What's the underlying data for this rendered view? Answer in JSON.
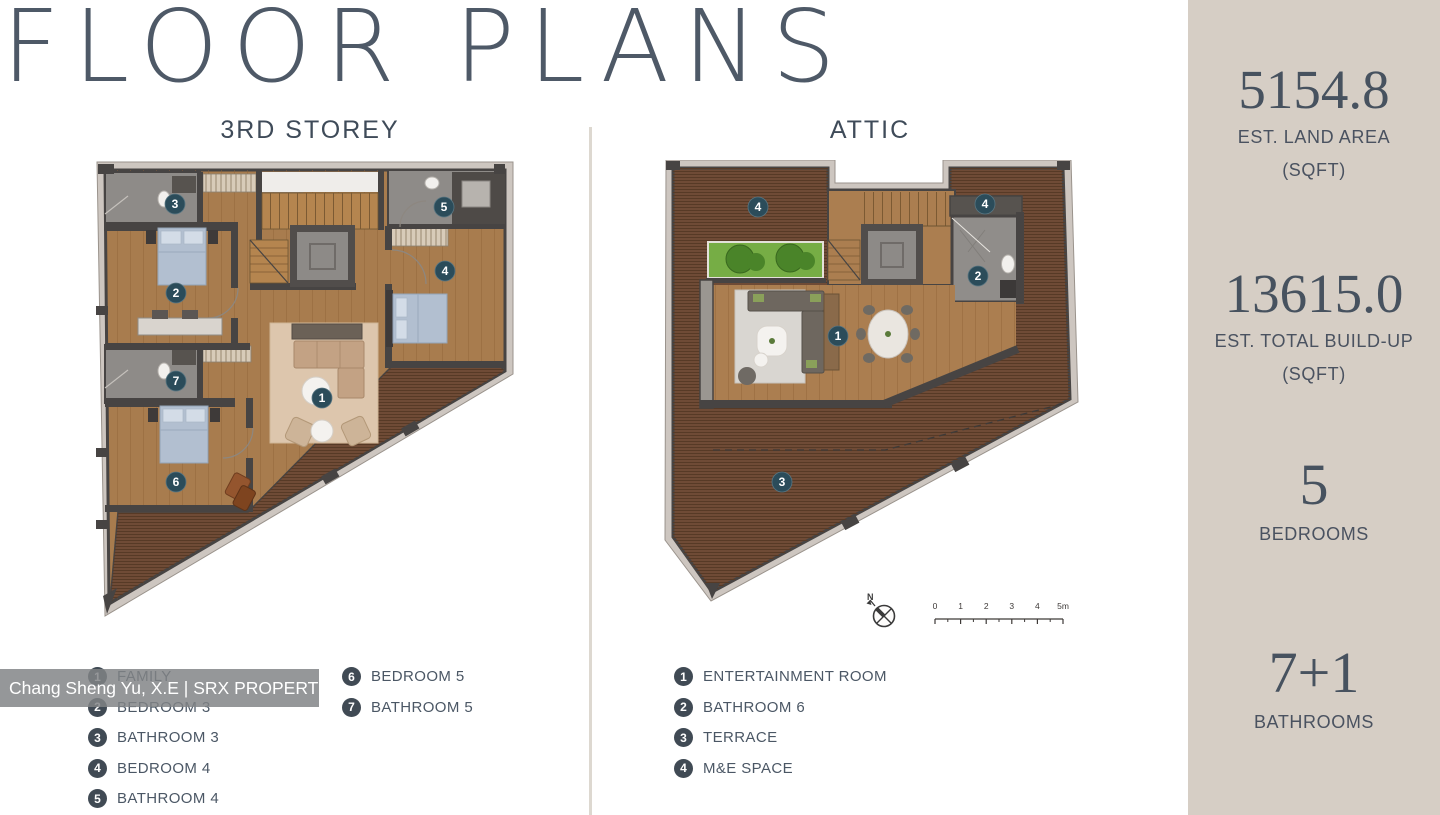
{
  "page": {
    "title": "FLOOR PLANS"
  },
  "plans": [
    {
      "label": "3RD STOREY",
      "legend": [
        {
          "n": "1",
          "label": "FAMILY"
        },
        {
          "n": "2",
          "label": "BEDROOM 3"
        },
        {
          "n": "3",
          "label": "BATHROOM 3"
        },
        {
          "n": "4",
          "label": "BEDROOM 4"
        },
        {
          "n": "5",
          "label": "BATHROOM 4"
        },
        {
          "n": "6",
          "label": "BEDROOM 5"
        },
        {
          "n": "7",
          "label": "BATHROOM 5"
        }
      ]
    },
    {
      "label": "ATTIC",
      "legend": [
        {
          "n": "1",
          "label": "ENTERTAINMENT ROOM"
        },
        {
          "n": "2",
          "label": "BATHROOM 6"
        },
        {
          "n": "3",
          "label": "TERRACE"
        },
        {
          "n": "4",
          "label": "M&E SPACE"
        }
      ]
    }
  ],
  "sidebar": {
    "stats": [
      {
        "value": "5154.8",
        "caption": "EST. LAND AREA",
        "sub": "(SQFT)"
      },
      {
        "value": "13615.0",
        "caption": "EST. TOTAL BUILD-UP",
        "sub": "(SQFT)"
      },
      {
        "value": "5",
        "caption": "BEDROOMS",
        "sub": ""
      },
      {
        "value": "7+1",
        "caption": "BATHROOMS",
        "sub": ""
      }
    ]
  },
  "watermark": {
    "text": "Chang Sheng Yu, X.E | SRX PROPERTY"
  },
  "attic_annotations": {
    "compass": "N",
    "scale_ticks": [
      "0",
      "1",
      "2",
      "3",
      "4",
      "5m"
    ]
  },
  "colors": {
    "sidebar_bg": "#d6cec5",
    "slate_text": "#4a5664",
    "title_text": "#4e5967",
    "legend_badge": "#404a54",
    "plan_badge": "#2b4c5a",
    "wood_floor": "#a87c4e",
    "deck": "#6f4b36",
    "bathroom": "#8e8b88",
    "wall": "#474443",
    "rug": "#ddc6ad",
    "planter_green": "#76ad45",
    "bed": "#b2bfd0",
    "outer_band": "#cdc6c0"
  }
}
